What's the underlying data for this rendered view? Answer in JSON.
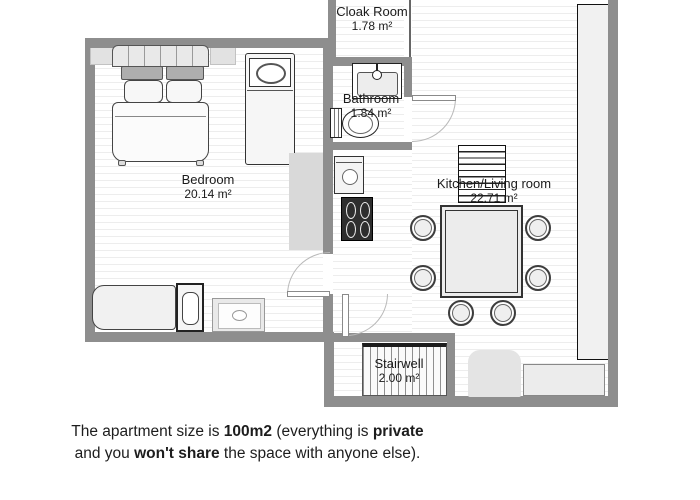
{
  "rooms": {
    "cloak_room": {
      "name": "Cloak Room",
      "area": "1.78 m²"
    },
    "bathroom": {
      "name": "Bathroom",
      "area": "1.84 m²"
    },
    "bedroom": {
      "name": "Bedroom",
      "area": "20.14 m²"
    },
    "kitchen_living": {
      "name": "Kitchen/Living room",
      "area": "22.71 m²"
    },
    "stairwell": {
      "name": "Stairwell",
      "area": "2.00 m²"
    }
  },
  "caption": {
    "l1_t1": "The apartment size is ",
    "l1_b1": "100m2",
    "l1_t2": " (everything is ",
    "l1_b2": "private",
    "l2_t1": "and you ",
    "l2_b1": "won't share",
    "l2_t2": " the space with anyone else)."
  },
  "colors": {
    "wall_gray": "#8e8e8e",
    "floor_stripe": "#ededed",
    "stove_dark": "#2e2e2e"
  }
}
